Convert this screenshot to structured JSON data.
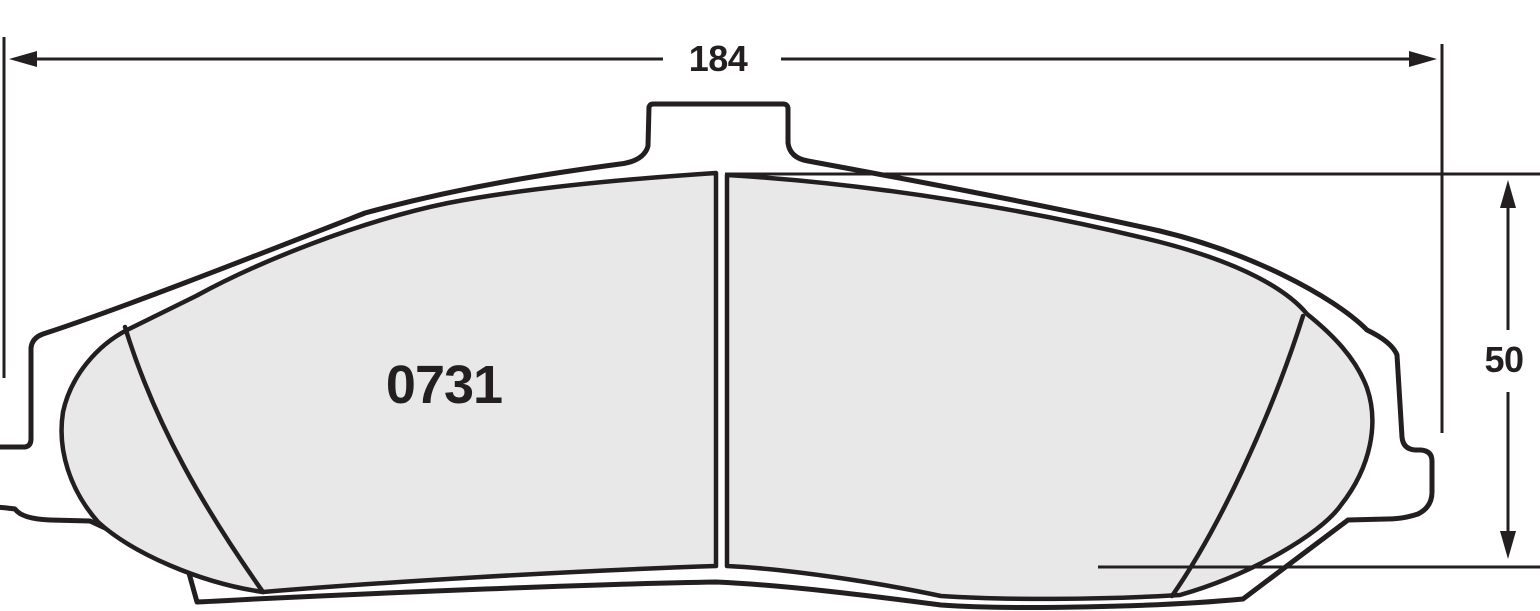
{
  "drawing": {
    "type": "technical-drawing",
    "subject": "brake pad friction-surface view",
    "part_number": "0731",
    "dimensions": {
      "width": {
        "value": "184"
      },
      "height": {
        "value": "50"
      }
    }
  },
  "colors": {
    "background": "#ffffff",
    "line_color": "#231f20",
    "plate_fill": "#ffffff",
    "friction_fill": "#e8e8e8"
  }
}
